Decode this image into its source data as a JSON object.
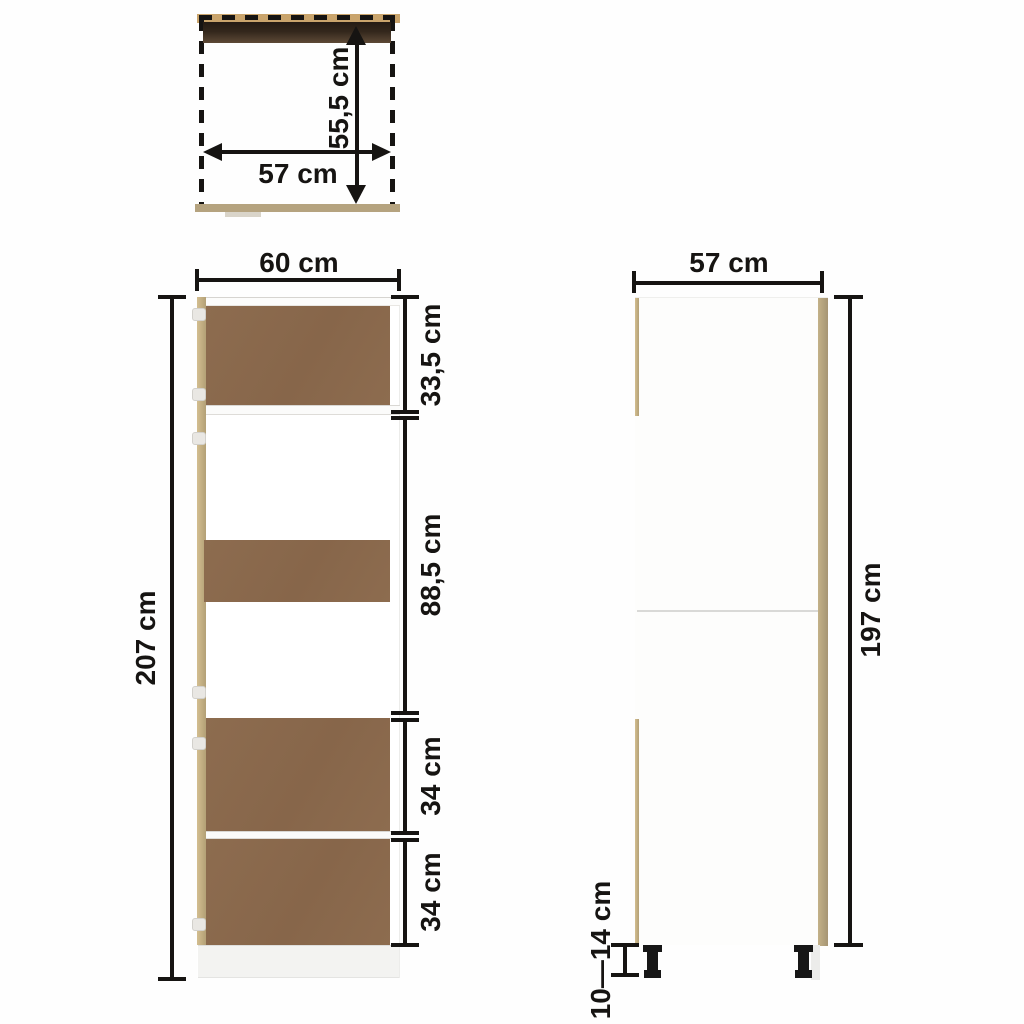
{
  "title": "Cabinet dimension diagram",
  "top_view": {
    "depth_label": "55,5 cm",
    "width_label": "57 cm"
  },
  "front_view": {
    "width_label": "60 cm",
    "height_label": "207 cm",
    "sections": [
      {
        "label": "33,5 cm"
      },
      {
        "label": "88,5 cm"
      },
      {
        "label": "34 cm"
      },
      {
        "label": "34 cm"
      }
    ]
  },
  "side_view": {
    "width_label": "57 cm",
    "height_label": "197 cm",
    "leg_height_label": "10—14 cm"
  },
  "colors": {
    "text": "#161412",
    "line": "#161412",
    "brown_panel": "#8d6c4f",
    "oak_edge": "#b3a076",
    "oak_edge_light": "#d3be90",
    "dark_top_strip": "#33271c",
    "top_tan_strip": "#c9a46c",
    "bottom_tan_strip": "#b5a37f",
    "plinth": "#f3f3f1"
  }
}
